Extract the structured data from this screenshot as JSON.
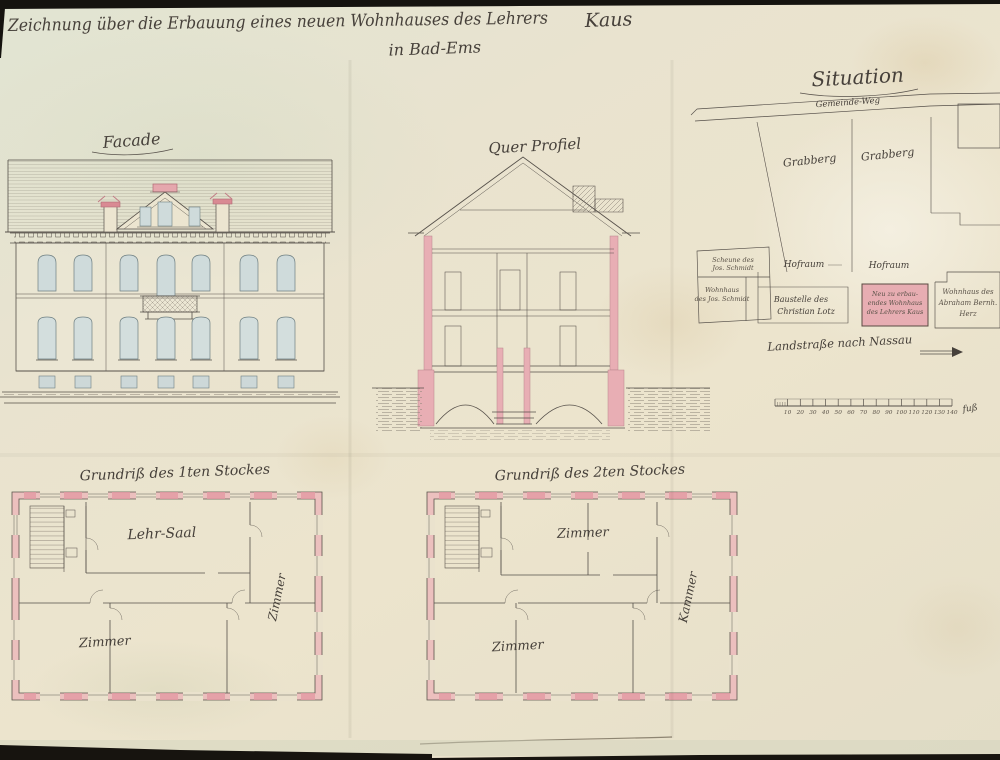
{
  "sheet": {
    "title_line1": "Zeichnung über die Erbauung eines neuen Wohnhauses des Lehrers",
    "title_name": "Kaus",
    "title_line2": "in Bad-Ems"
  },
  "facade": {
    "label": "Facade"
  },
  "section": {
    "label": "Quer Profiel"
  },
  "situation": {
    "title": "Situation",
    "road_top": "Gemeinde-Weg",
    "parcel_left": "Grabberg",
    "parcel_right": "Grabberg",
    "hofraum_left": "Hofraum",
    "hofraum_right": "Hofraum",
    "scheune_l1": "Scheune des",
    "scheune_l2": "Jos. Schmidt",
    "schmidt_l1": "Wohnhaus",
    "schmidt_l2": "des Jos. Schmidt",
    "baustelle_l1": "Baustelle des",
    "baustelle_l2": "Christian Lotz",
    "neubau_l1": "Neu zu erbau-",
    "neubau_l2": "endes Wohnhaus",
    "neubau_l3": "des Lehrers Kaus",
    "herz_l1": "Wohnhaus des",
    "herz_l2": "Abraham Bernh.",
    "herz_l3": "Herz",
    "road_bottom": "Landstraße nach Nassau",
    "scale_ticks": [
      "10",
      "20",
      "30",
      "40",
      "50",
      "60",
      "70",
      "80",
      "90",
      "100",
      "110",
      "120",
      "130",
      "140"
    ],
    "scale_unit": "fuß"
  },
  "plan_first": {
    "label": "Grundriß des 1ten Stockes",
    "room_hall": "Lehr-Saal",
    "room_left": "Zimmer",
    "room_right": "Zimmer"
  },
  "plan_second": {
    "label": "Grundriß des 2ten Stockes",
    "room_top": "Zimmer",
    "room_left": "Zimmer",
    "room_right": "Kammer"
  },
  "colors": {
    "paper": "#eae3cd",
    "ink": "#46403a",
    "wall_pink": "#ecb6ba",
    "window_blue": "#cfdbdb"
  }
}
